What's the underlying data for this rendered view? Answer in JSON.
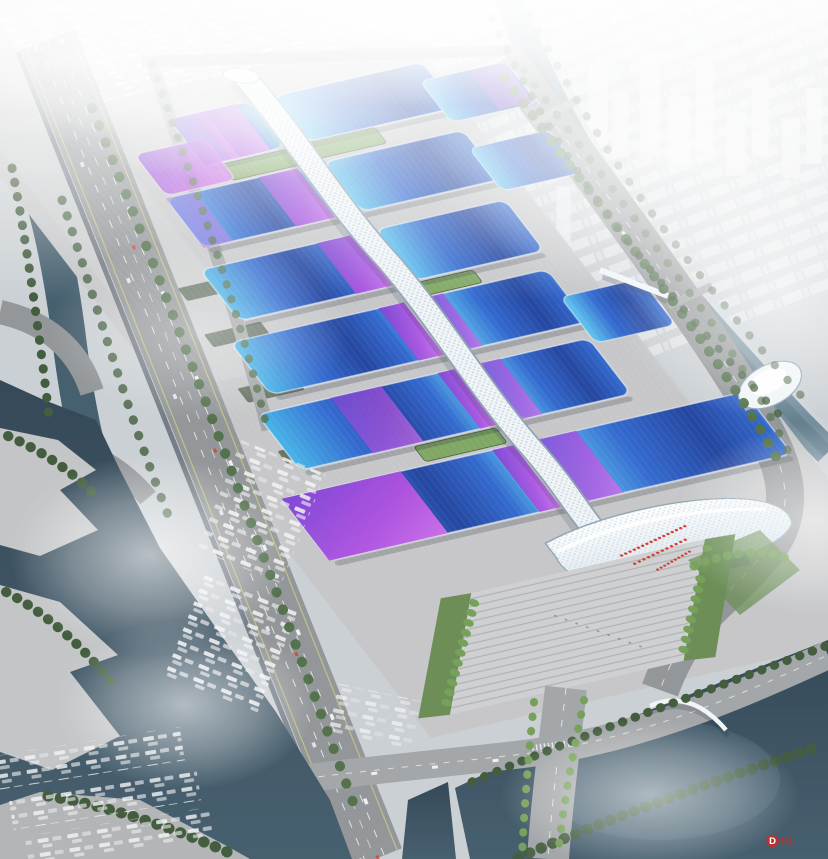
{
  "meta": {
    "scene_type": "aerial architectural rendering",
    "subject": "riverside exhibition and convention center complex",
    "atmosphere": "hazy daylight, fog over water and distant skyline"
  },
  "complex": {
    "hall_rows": 6,
    "roof_style": "curved wave roofs, cyan-to-navy blue with violet-magenta sashes",
    "central_spine": "white quilted serpentine concourse running the full length",
    "south_end": "wave-form white entrance canopy with terraced arrival plaza, palms and red crowd",
    "north_end": "truck marshalling yard with rows of parked trailers",
    "roof_garden_strips": 3
  },
  "context": {
    "west": "elevated multi-lane highway and interchange beside a dark lake with stepped waterfront terraces",
    "east": "tree-lined arterial road and winding canal crossed by bridges",
    "south": "road bridges over a dark basin, arc footbridge, white shell pavilion",
    "skyline": "white high-rise city dissolving into fog"
  },
  "watermark": {
    "logo_letter": "D",
    "logo_text": "IM"
  },
  "palette": {
    "sky": "#c9ced2",
    "city-low": "#f2f4f5",
    "tower": "#e8ebed",
    "tower-edge": "#d3d8da",
    "canal": "#6e8998",
    "canal-deep": "#54707f",
    "canal-bank": "#cdd2d4",
    "lake": "#3e5868",
    "lake-deep": "#2b4050",
    "water-sheen": "#5b7889",
    "ground": "#c4c5c7",
    "yard": "#cbcccd",
    "plaza": "#cdcecf",
    "stair-line": "#a4a6a8",
    "road": "#8f9295",
    "road-light": "#a0a3a5",
    "lane-white": "#eef0f1",
    "lane-yellow": "#c6cc7a",
    "bank-wall": "#57636d",
    "roof-cyan": "#3fb1e7",
    "roof-blue": "#2a63cd",
    "roof-navy": "#1a3e9c",
    "roof-sky": "#5ac5f0",
    "roof-violet": "#7c3ad2",
    "roof-magenta": "#b04ae0",
    "roof-magenta-light": "#d06ae9",
    "spine-white": "#f1f5f8",
    "spine-shade": "#b7c8d2",
    "spine-edge": "#8aa1b0",
    "canopy-shade": "#d3e2ec",
    "glass": "#44566a",
    "lawn": "#66894f",
    "lawn-bright": "#7aa35c",
    "tree": "#4c6b45",
    "tree-dark": "#3a5535",
    "palm": "#6f9c52",
    "shed": "#616d5e",
    "terrace": "#c0c2c4",
    "terrace-dark": "#b0b2b4",
    "shadow": "#16202c",
    "people-red": "#d63426",
    "truck-white": "#f3f4f5",
    "truck-grey": "#dfe2e4",
    "watermark-red": "#c22f2f",
    "fog": "#ffffff"
  }
}
